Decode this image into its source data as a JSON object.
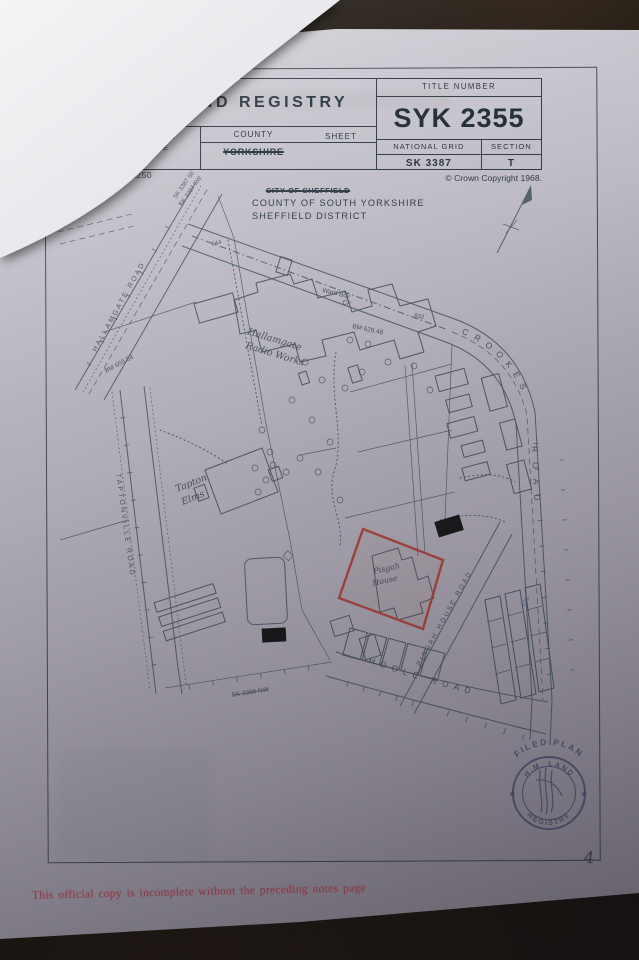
{
  "header": {
    "title": "H.M.  LAND  REGISTRY",
    "title_number_label": "TITLE NUMBER",
    "title_number": "SYK 2355",
    "os_label": "ORDNANCE SURVEY PLAN REFERENCE",
    "county_label": "COUNTY",
    "county_value": "YORKSHIRE",
    "sheet_label": "SHEET",
    "national_grid_label": "NATIONAL GRID",
    "national_grid_value": "SK 3387",
    "section_label": "SECTION",
    "section_value": "T",
    "scale": "Scale: 1 1250",
    "copyright": "© Crown Copyright 1968."
  },
  "subheader": {
    "struck_city": "CITY OF SHEFFIELD",
    "county_line": "COUNTY OF SOUTH YORKSHIRE",
    "district_line": "SHEFFIELD DISTRICT"
  },
  "map": {
    "labels": [
      {
        "t": "SK 3387 SE",
        "x": 176,
        "y": 199,
        "r": -55,
        "s": 6,
        "c": "ml"
      },
      {
        "t": "SK 3387 SW",
        "x": 182,
        "y": 206,
        "r": -55,
        "s": 6,
        "c": "ml"
      },
      {
        "t": "644",
        "x": 212,
        "y": 246,
        "r": -14,
        "s": 6,
        "c": "ml"
      },
      {
        "t": "Ward Bdy",
        "x": 322,
        "y": 292,
        "r": 13,
        "s": 6.5,
        "c": "ml"
      },
      {
        "t": "CF",
        "x": 342,
        "y": 304,
        "r": 13,
        "s": 6.5,
        "c": "ml"
      },
      {
        "t": "BM 628.48",
        "x": 352,
        "y": 328,
        "r": 12,
        "s": 6.5,
        "c": "ml"
      },
      {
        "t": "632",
        "x": 414,
        "y": 317,
        "r": 12,
        "s": 6,
        "c": "ml"
      },
      {
        "t": "BM 655.54",
        "x": 106,
        "y": 373,
        "r": -28,
        "s": 6.5,
        "c": "ml"
      },
      {
        "t": "Hallamgate",
        "x": 247,
        "y": 334,
        "r": 17,
        "s": 9.5,
        "c": "it"
      },
      {
        "t": "Radio Works",
        "x": 245,
        "y": 348,
        "r": 17,
        "s": 9.5,
        "c": "it"
      },
      {
        "t": "HALLAMGATE  ROAD",
        "x": 96,
        "y": 352,
        "r": -61,
        "s": 7,
        "c": "ml sp"
      },
      {
        "t": "TAPTONVILLE  ROAD",
        "x": 116,
        "y": 474,
        "r": 82,
        "s": 7,
        "c": "ml sp"
      },
      {
        "t": "Tapton",
        "x": 177,
        "y": 492,
        "r": -22,
        "s": 9.5,
        "c": "it"
      },
      {
        "t": "Elms",
        "x": 183,
        "y": 505,
        "r": -22,
        "s": 9.5,
        "c": "it"
      },
      {
        "t": "Pisgah",
        "x": 374,
        "y": 574,
        "r": -13,
        "s": 8,
        "c": "it"
      },
      {
        "t": "House",
        "x": 373,
        "y": 586,
        "r": -13,
        "s": 8,
        "c": "it"
      },
      {
        "t": "PISGAH  HOUSE  ROAD",
        "x": 420,
        "y": 666,
        "r": -61,
        "s": 6.5,
        "c": "ml sp"
      },
      {
        "t": "SK 3386 NW",
        "x": 232,
        "y": 697,
        "r": -9,
        "s": 6.5,
        "c": "ml strike"
      },
      {
        "t": "578",
        "x": 526,
        "y": 607,
        "r": -70,
        "s": 6,
        "c": "blue"
      }
    ],
    "road_labels": {
      "crookes_word1": "CROOKES",
      "crookes_word2": "ROAD",
      "hoole": "HOOLE ROAD"
    }
  },
  "stamp": {
    "filed_plan": "FILED PLAN",
    "arc_top": "H.M. LAND",
    "arc_bottom": "REGISTRY",
    "star": "★"
  },
  "footer": {
    "note": "This official copy is incomplete without the preceding notes page",
    "page_number": "4"
  }
}
